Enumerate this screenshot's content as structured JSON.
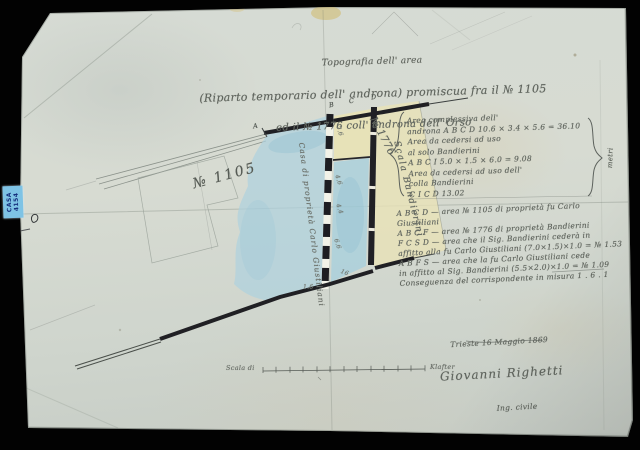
{
  "tag": {
    "line1": "CASA",
    "line2": "4154"
  },
  "title": {
    "line1": "Topografia dell' area",
    "line2": "(Riparto temporario dell' androna) promiscua fra il № 1105",
    "line3": "ed il № 1776 coll' androna dell' Orso"
  },
  "plan": {
    "parcel_left": "№ 1105",
    "parcel_right": "№ 1776",
    "strip_label": "Scala Bandierini",
    "left_wall_label": "Casa di proprietà Carlo Giustiliani",
    "points": [
      "A",
      "B",
      "C",
      "D"
    ],
    "measurements": [
      "7.6",
      "4.6",
      "4.4",
      "6.6",
      "16",
      "1.6"
    ]
  },
  "calc": {
    "rows": [
      "Area complessiva dell'",
      "androna A B C D      10.6 × 3.4 × 5.6 = 36.10",
      "Area da cedersi ad uso",
      "    al solo Bandierini",
      "    A B C I              5.0 × 1.5 × 6.0 = 9.08",
      "Area da cedersi ad uso dell'",
      "    colla Bandierini",
      "    C I C D                                        13.02"
    ],
    "side_note": "metri"
  },
  "legend": {
    "rows": [
      "A B C D — area № 1105 di proprietà fu Carlo",
      "      Giustiliani",
      "A B C F — area № 1776 di proprietà Bandierini",
      "F C S D — area che il Sig. Bandierini cederà in",
      "      affitto alla fu Carlo Giustiliani (7.0×1.5)×1.0 = № 1.53",
      "A B F S — area che la fu Carlo Giustiliani cede",
      "      in affitto al Sig. Bandierini (5.5×2.0)×1.0 = № 1.09",
      "Conseguenza del corrispondente in misura          1 . 6 . 1"
    ]
  },
  "signature": {
    "place_date": "Trieste 16 Maggio 1869",
    "name": "Giovanni Righetti",
    "title": "Ing. civile"
  },
  "scale": {
    "left": "Scala di",
    "right": "Klafter"
  }
}
